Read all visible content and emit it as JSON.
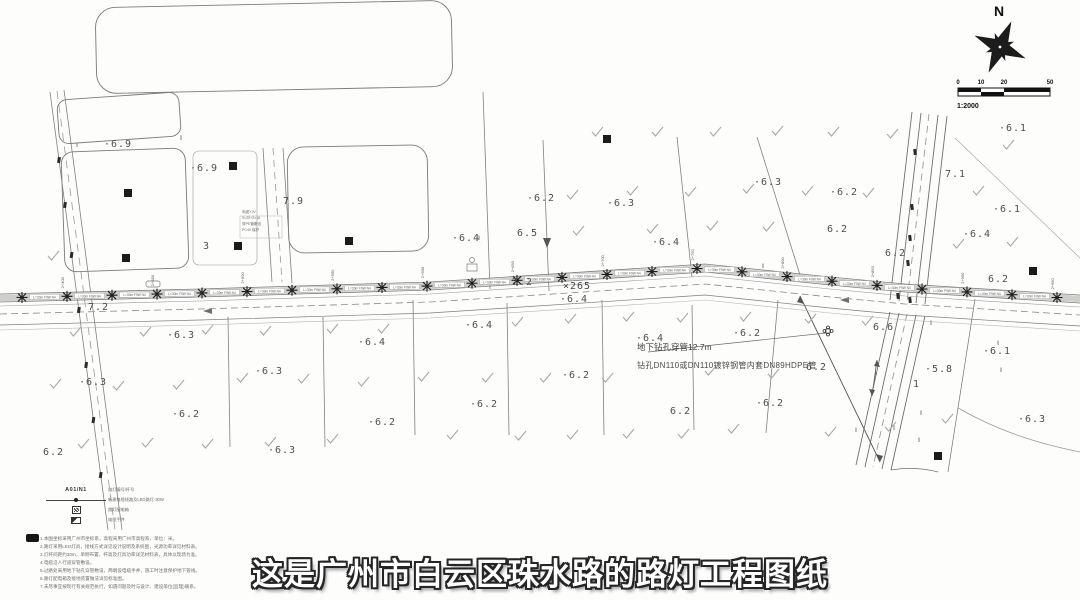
{
  "caption": "这是广州市白云区珠水路的路灯工程图纸",
  "compass": {
    "label": "N"
  },
  "scale_bar": {
    "ticks": [
      "0",
      "10",
      "20",
      "50"
    ],
    "ratio": "1:2000"
  },
  "annotation": {
    "line1": "地下钻孔穿管12.7m",
    "line2": "钻孔DN110或DN110镀锌钢管内套DN89HDPE管"
  },
  "station_marker": "×265",
  "lamp_label": "L=30m F9W N4",
  "lamps": {
    "xs": [
      22,
      67,
      112,
      157,
      202,
      247,
      292,
      337,
      382,
      427,
      472,
      517,
      562,
      607,
      652,
      697,
      742,
      787,
      832,
      877,
      922,
      967,
      1012,
      1057
    ]
  },
  "stations": [
    "2+400",
    "2+450",
    "2+500",
    "2+550",
    "2+600",
    "2+650",
    "2+700",
    "2+750",
    "2+800",
    "2+850",
    "2+900",
    "2+950"
  ],
  "elevations": [
    [
      104,
      147,
      "·6.9"
    ],
    [
      190,
      171,
      "·6.9"
    ],
    [
      283,
      204,
      "7.9"
    ],
    [
      203,
      249,
      "3"
    ],
    [
      527,
      201,
      "·6.2"
    ],
    [
      607,
      206,
      "·6.3"
    ],
    [
      754,
      185,
      "·6.3"
    ],
    [
      830,
      195,
      "·6.2"
    ],
    [
      452,
      241,
      "·6.4"
    ],
    [
      517,
      236,
      "6.5"
    ],
    [
      652,
      245,
      "·6.4"
    ],
    [
      999,
      131,
      "·6.1"
    ],
    [
      945,
      177,
      "7.1"
    ],
    [
      993,
      212,
      "·6.1"
    ],
    [
      963,
      237,
      "·6.4"
    ],
    [
      885,
      256,
      "6.2"
    ],
    [
      988,
      282,
      "6.2"
    ],
    [
      827,
      232,
      "6.2"
    ],
    [
      88,
      310,
      "7.2"
    ],
    [
      512,
      285,
      "7.2"
    ],
    [
      560,
      302,
      "·6.4"
    ],
    [
      465,
      328,
      "·6.4"
    ],
    [
      167,
      338,
      "·6.3"
    ],
    [
      358,
      345,
      "·6.4"
    ],
    [
      733,
      336,
      "·6.2"
    ],
    [
      873,
      330,
      "6.6"
    ],
    [
      79,
      385,
      "·6.3"
    ],
    [
      255,
      374,
      "·6.3"
    ],
    [
      562,
      378,
      "·6.2"
    ],
    [
      806,
      370,
      "6.2"
    ],
    [
      925,
      372,
      "·5.8"
    ],
    [
      983,
      354,
      "·6.1"
    ],
    [
      172,
      417,
      "·6.2"
    ],
    [
      368,
      425,
      "·6.2"
    ],
    [
      470,
      407,
      "·6.2"
    ],
    [
      670,
      414,
      "6.2"
    ],
    [
      756,
      406,
      "·6.2"
    ],
    [
      43,
      455,
      "6.2"
    ],
    [
      268,
      453,
      "·6.3"
    ],
    [
      1018,
      422,
      "·6.3"
    ],
    [
      636,
      341,
      "·6.4"
    ],
    [
      913,
      387,
      "1"
    ]
  ],
  "checkmarks": [
    [
      597,
      133
    ],
    [
      657,
      133
    ],
    [
      715,
      133
    ],
    [
      777,
      132
    ],
    [
      833,
      133
    ],
    [
      892,
      135
    ],
    [
      1008,
      146
    ],
    [
      572,
      196
    ],
    [
      632,
      192
    ],
    [
      690,
      193
    ],
    [
      748,
      190
    ],
    [
      807,
      192
    ],
    [
      868,
      194
    ],
    [
      978,
      192
    ],
    [
      578,
      232
    ],
    [
      652,
      230
    ],
    [
      712,
      227
    ],
    [
      768,
      228
    ],
    [
      958,
      245
    ],
    [
      1012,
      243
    ],
    [
      53,
      257
    ],
    [
      75,
      333
    ],
    [
      145,
      333
    ],
    [
      207,
      331
    ],
    [
      265,
      332
    ],
    [
      332,
      330
    ],
    [
      383,
      330
    ],
    [
      517,
      323
    ],
    [
      570,
      320
    ],
    [
      628,
      318
    ],
    [
      682,
      319
    ],
    [
      745,
      318
    ],
    [
      810,
      320
    ],
    [
      867,
      322
    ],
    [
      55,
      385
    ],
    [
      118,
      387
    ],
    [
      178,
      386
    ],
    [
      242,
      379
    ],
    [
      303,
      380
    ],
    [
      363,
      383
    ],
    [
      423,
      378
    ],
    [
      487,
      379
    ],
    [
      545,
      379
    ],
    [
      607,
      379
    ],
    [
      710,
      372
    ],
    [
      773,
      375
    ],
    [
      83,
      445
    ],
    [
      147,
      444
    ],
    [
      207,
      445
    ],
    [
      270,
      443
    ],
    [
      332,
      440
    ],
    [
      452,
      436
    ],
    [
      520,
      437
    ],
    [
      572,
      436
    ],
    [
      628,
      435
    ],
    [
      683,
      435
    ],
    [
      733,
      430
    ],
    [
      830,
      433
    ],
    [
      890,
      428
    ],
    [
      947,
      420
    ]
  ],
  "squares": [
    [
      128,
      193
    ],
    [
      126,
      258
    ],
    [
      233,
      166
    ],
    [
      238,
      246
    ],
    [
      349,
      241
    ],
    [
      607,
      139
    ],
    [
      938,
      456
    ],
    [
      1033,
      271
    ]
  ],
  "double_ticks": [
    [
      180,
      140
    ],
    [
      76,
      147
    ],
    [
      478,
      240
    ],
    [
      762,
      268
    ],
    [
      875,
      375
    ],
    [
      920,
      415
    ],
    [
      918,
      442
    ],
    [
      930,
      325
    ],
    [
      997,
      345
    ],
    [
      855,
      432
    ],
    [
      893,
      430
    ],
    [
      1000,
      372
    ]
  ],
  "left_road_pole_ys": [
    160,
    205,
    255,
    310,
    365,
    420,
    475
  ],
  "right_road_poles": [
    [
      915,
      152
    ],
    [
      912,
      207
    ],
    [
      910,
      238
    ],
    [
      908,
      263
    ],
    [
      898,
      296
    ],
    [
      910,
      300
    ]
  ],
  "cable_note": {
    "lines": [
      "电缆YJV",
      "3×25+2×16",
      "穿PE管敷设",
      "PC40 保护"
    ]
  },
  "legend": {
    "rows": [
      {
        "type": "code",
        "sym_text": "A01/N1",
        "label": "路灯编号/杆号"
      },
      {
        "type": "cable",
        "label": "新建电缆线路及LED路灯·30W"
      },
      {
        "type": "box",
        "label": "路灯配电箱"
      },
      {
        "type": "well",
        "label": "电缆手井"
      }
    ]
  },
  "notes": [
    "1.本图坐标采用广州市坐标系，高程采用广州市高程系，单位：米。",
    "2.路灯采用LED灯具，接线方式详见设计说明及系统图，光源功率详见材料表。",
    "3.灯杆间距约30m，单侧布置，杆高及灯具功率详见材料表，具体以现场为准。",
    "4.电缆沿人行道穿管敷设。",
    "5.过路处采用地下钻孔穿管敷设，两端设电缆手井，施工时注意保护地下管线。",
    "6.路灯配电箱及接地装置做法详见标准图。",
    "7.未尽事宜按现行有关规范执行，如遇问题及时与设计、建设单位(监理)联系。"
  ]
}
